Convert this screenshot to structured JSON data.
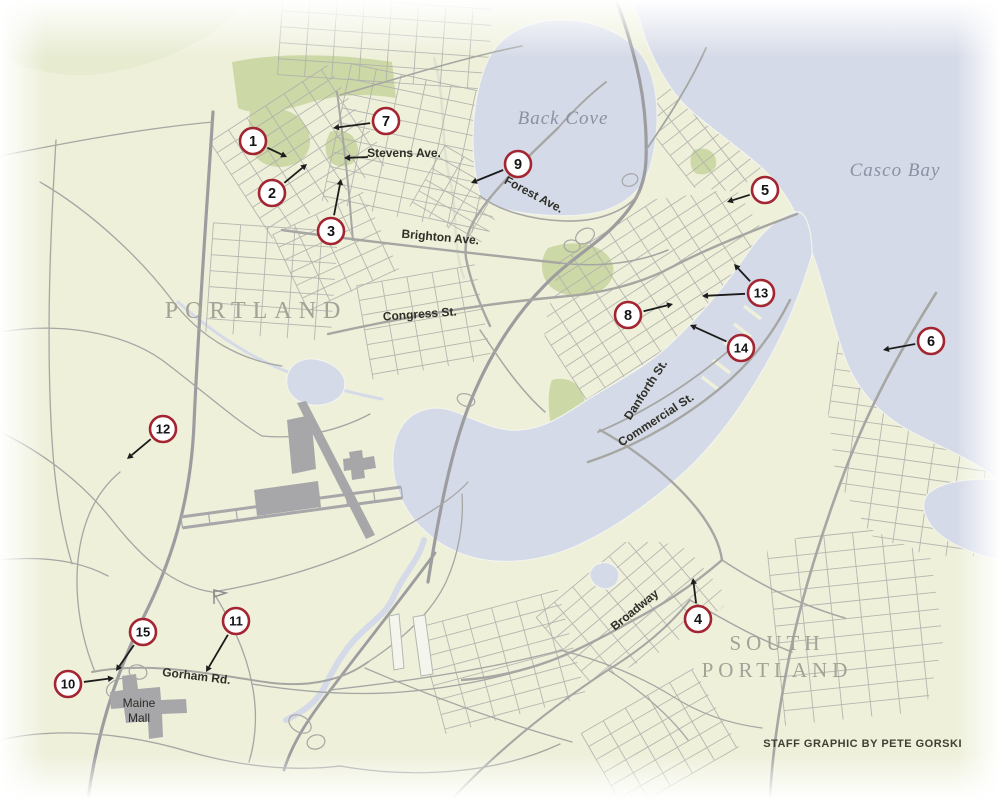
{
  "credit": "STAFF GRAPHIC BY PETE GORSKI",
  "colors": {
    "land": "#eef0da",
    "water": "#d5dae8",
    "water_edge": "#f2f4ec",
    "park": "#ccd8a6",
    "road": "#a6a6a3",
    "road_minor": "#b0b0ac",
    "highway": "#9d9da0",
    "building": "#a7a7aa",
    "marker_ring": "#a32531",
    "marker_fill": "#ffffff",
    "marker_text": "#141414",
    "arrow": "#1c1c1c",
    "city_label": "#a2a297",
    "water_label": "#8b91a2",
    "street_label": "#2f2f27",
    "poi_label": "#2b2b25"
  },
  "city_labels": [
    {
      "text": "PORTLAND",
      "x": 256,
      "y": 318,
      "size": 24,
      "spacing": 7
    },
    {
      "text": "SOUTH",
      "x": 777,
      "y": 650,
      "size": 21,
      "spacing": 5
    },
    {
      "text": "PORTLAND",
      "x": 777,
      "y": 677,
      "size": 21,
      "spacing": 5
    }
  ],
  "water_labels": [
    {
      "text": "Back Cove",
      "x": 563,
      "y": 124,
      "size": 19
    },
    {
      "text": "Casco Bay",
      "x": 895,
      "y": 176,
      "size": 19
    }
  ],
  "poi_labels": [
    {
      "text": "Maine",
      "x": 139,
      "y": 707
    },
    {
      "text": "Mall",
      "x": 139,
      "y": 722
    }
  ],
  "street_labels": [
    {
      "text": "Stevens Ave.",
      "x": 404,
      "y": 157,
      "rot": 0,
      "anchor": "middle",
      "arrow": {
        "x1": 368,
        "y1": 157,
        "x2": 344,
        "y2": 158
      }
    },
    {
      "text": "Forest Ave.",
      "x": 532,
      "y": 198,
      "rot": 28,
      "anchor": "middle"
    },
    {
      "text": "Brighton Ave.",
      "x": 440,
      "y": 241,
      "rot": 5,
      "anchor": "middle"
    },
    {
      "text": "Congress St.",
      "x": 420,
      "y": 318,
      "rot": -4,
      "anchor": "middle"
    },
    {
      "text": "Danforth St.",
      "x": 649,
      "y": 392,
      "rot": -57,
      "anchor": "middle"
    },
    {
      "text": "Commercial St.",
      "x": 658,
      "y": 423,
      "rot": -33,
      "anchor": "middle"
    },
    {
      "text": "Broadway",
      "x": 637,
      "y": 613,
      "rot": -39,
      "anchor": "middle"
    },
    {
      "text": "Gorham Rd.",
      "x": 196,
      "y": 680,
      "rot": 7,
      "anchor": "middle"
    }
  ],
  "markers": [
    {
      "n": "1",
      "cx": 253,
      "cy": 141,
      "arrows": [
        [
          287,
          157
        ]
      ]
    },
    {
      "n": "2",
      "cx": 272,
      "cy": 193,
      "arrows": [
        [
          307,
          164
        ]
      ]
    },
    {
      "n": "3",
      "cx": 331,
      "cy": 231,
      "arrows": [
        [
          341,
          179
        ]
      ]
    },
    {
      "n": "4",
      "cx": 698,
      "cy": 619,
      "arrows": [
        [
          693,
          578
        ]
      ]
    },
    {
      "n": "5",
      "cx": 765,
      "cy": 190,
      "arrows": [
        [
          727,
          202
        ]
      ]
    },
    {
      "n": "6",
      "cx": 931,
      "cy": 341,
      "arrows": [
        [
          883,
          350
        ]
      ]
    },
    {
      "n": "7",
      "cx": 386,
      "cy": 121,
      "arrows": [
        [
          333,
          128
        ]
      ]
    },
    {
      "n": "8",
      "cx": 628,
      "cy": 315,
      "arrows": [
        [
          673,
          304
        ]
      ]
    },
    {
      "n": "9",
      "cx": 518,
      "cy": 164,
      "arrows": [
        [
          471,
          183
        ]
      ]
    },
    {
      "n": "10",
      "cx": 68,
      "cy": 684,
      "arrows": [
        [
          114,
          678
        ]
      ]
    },
    {
      "n": "11",
      "cx": 236,
      "cy": 621,
      "arrows": [
        [
          206,
          672
        ]
      ]
    },
    {
      "n": "12",
      "cx": 163,
      "cy": 429,
      "arrows": [
        [
          127,
          459
        ]
      ]
    },
    {
      "n": "13",
      "cx": 761,
      "cy": 293,
      "arrows": [
        [
          734,
          264
        ],
        [
          702,
          296
        ]
      ]
    },
    {
      "n": "14",
      "cx": 741,
      "cy": 348,
      "arrows": [
        [
          690,
          325
        ]
      ]
    },
    {
      "n": "15",
      "cx": 143,
      "cy": 632,
      "arrows": [
        [
          116,
          671
        ]
      ]
    }
  ],
  "map": {
    "washes": [
      {
        "name": "north-woods-wash",
        "d": "M0,0 L250,0 C210,42 165,62 112,72 C70,80 30,72 0,56 Z",
        "c": "#e3e8ca",
        "o": 0.6
      },
      {
        "name": "cove-north-wash",
        "d": "M250,0 L640,0 L640,26 C520,40 360,36 250,18 Z",
        "c": "#e9edd2",
        "o": 0.5
      }
    ],
    "parks": [
      {
        "name": "evergreen-cemetery",
        "d": "M232,62 C280,52 340,54 392,62 L396,98 C360,92 330,96 305,104 C280,112 255,116 238,108 Z"
      },
      {
        "name": "evergreen-south",
        "d": "M250,108 C280,104 300,112 308,130 C314,148 306,162 288,166 C268,170 252,160 248,142 Z"
      },
      {
        "name": "baxter-woods",
        "d": "M330,132 C344,128 356,134 358,148 C360,160 350,168 338,166 C328,164 324,152 326,142 Z"
      },
      {
        "name": "deering-oaks",
        "d": "M548,248 C570,240 596,242 608,256 C618,268 614,284 598,292 C580,300 558,296 548,284 C540,274 540,258 548,248 Z"
      },
      {
        "name": "eastern-prom",
        "d": "M668,52 C700,40 740,44 775,62 C805,78 828,98 838,118 C830,142 812,158 790,166 C775,150 765,130 752,112 C735,88 700,66 668,52 Z"
      },
      {
        "name": "west-end-green",
        "d": "M552,380 C566,376 580,382 584,398 C590,420 584,444 572,456 C560,452 552,440 550,420 C548,404 548,390 552,380 Z"
      },
      {
        "name": "sp-shore-green",
        "d": "M890,244 C905,238 922,242 930,252 C934,262 928,272 914,274 C900,276 888,268 886,256 Z"
      },
      {
        "name": "peninsula-green",
        "d": "M694,150 C704,146 714,150 716,160 C718,170 708,176 698,174 C690,172 688,158 694,150 Z"
      }
    ],
    "streams": [
      {
        "name": "stroudwater-river",
        "d": "M178,302 C215,335 252,358 288,372 C318,384 350,393 382,399",
        "w": 3
      },
      {
        "name": "fore-river-arm",
        "d": "M424,540 C418,562 402,576 394,596 C386,614 372,622 358,636 C344,650 334,668 324,688 C314,706 298,714 286,720",
        "w": 6
      },
      {
        "name": "presumpscot-stream",
        "d": "M434,58 C446,98 440,140 450,180 C458,214 452,246 464,278",
        "w": 2.5,
        "c": "#dde3cf"
      }
    ],
    "grids": [
      {
        "name": "deering-center",
        "cx": 300,
        "cy": 152,
        "w": 140,
        "h": 115,
        "rot": -33,
        "step": 13
      },
      {
        "name": "oakdale",
        "cx": 420,
        "cy": 150,
        "w": 170,
        "h": 140,
        "rot": 12,
        "step": 15
      },
      {
        "name": "north-deering",
        "cx": 385,
        "cy": 42,
        "w": 210,
        "h": 80,
        "rot": 4,
        "step": 16
      },
      {
        "name": "back-cove-west",
        "cx": 462,
        "cy": 196,
        "w": 80,
        "h": 70,
        "rot": 30,
        "step": 13
      },
      {
        "name": "east-deering",
        "cx": 744,
        "cy": 108,
        "w": 175,
        "h": 120,
        "rot": -38,
        "step": 13,
        "clip": "M645,95 L668,42 L705,26 L762,44 L842,112 L800,172 L738,192 L678,186 L648,150 Z"
      },
      {
        "name": "peninsula",
        "cx": 668,
        "cy": 305,
        "w": 240,
        "h": 190,
        "rot": -33,
        "step": 13,
        "clip": "M560,258 L610,215 L648,200 L700,194 L800,178 L808,220 L772,262 L730,322 L688,372 L648,416 L608,442 L574,432 L552,398 L544,330 Z"
      },
      {
        "name": "libbytown",
        "cx": 424,
        "cy": 322,
        "w": 120,
        "h": 95,
        "rot": -10,
        "step": 15
      },
      {
        "name": "nasons-corner",
        "cx": 272,
        "cy": 282,
        "w": 125,
        "h": 110,
        "rot": 4,
        "step": 16
      },
      {
        "name": "rosemont",
        "cx": 336,
        "cy": 252,
        "w": 100,
        "h": 85,
        "rot": -25,
        "step": 14
      },
      {
        "name": "sp-center",
        "cx": 636,
        "cy": 612,
        "w": 160,
        "h": 120,
        "rot": -40,
        "step": 14,
        "clip": "M545,572 L602,542 L662,542 L732,562 L724,606 L668,648 L600,682 L540,676 L516,630 Z"
      },
      {
        "name": "sp-east",
        "cx": 916,
        "cy": 420,
        "w": 175,
        "h": 270,
        "rot": 8,
        "step": 16,
        "clip": "M836,282 L886,300 L940,288 L1000,320 L1000,556 L930,556 L872,536 L836,478 L824,380 L824,318 Z"
      },
      {
        "name": "sp-ferry-village",
        "cx": 858,
        "cy": 625,
        "w": 165,
        "h": 185,
        "rot": -6,
        "step": 17,
        "clip": "M768,548 L850,520 L930,556 L944,640 L922,722 L858,762 L788,770 L760,700 L760,600 Z"
      },
      {
        "name": "sp-west",
        "cx": 502,
        "cy": 662,
        "w": 145,
        "h": 110,
        "rot": -15,
        "step": 15
      },
      {
        "name": "sp-south",
        "cx": 660,
        "cy": 740,
        "w": 130,
        "h": 90,
        "rot": -30,
        "step": 15
      }
    ],
    "water": [
      {
        "name": "back-cove",
        "d": "M480,196 C468,150 472,95 488,60 C500,35 525,22 555,20 C595,18 632,36 646,62 C659,87 660,126 652,160 C645,190 625,205 600,212 C565,220 518,214 498,207 C488,203 483,200 480,196 Z"
      },
      {
        "name": "casco-bay",
        "d": "M630,0 L1000,0 L1000,480 C965,455 935,445 908,430 C878,413 856,388 845,358 C832,322 824,286 814,258 C800,218 786,190 762,168 C740,148 710,128 690,110 C668,90 650,55 642,28 C638,14 634,6 630,0 Z"
      },
      {
        "name": "fore-river-harbor",
        "d": "M812,255 C800,295 786,330 764,368 C740,410 712,448 678,478 C646,506 612,530 576,546 C540,562 500,566 468,556 C436,546 412,524 400,496 C390,472 390,444 402,426 C414,408 436,404 456,412 C476,420 498,432 520,430 C548,428 568,412 590,398 C616,382 644,368 668,346 C696,320 722,290 744,258 C760,234 778,216 796,212 C806,210 812,230 812,255 Z"
      },
      {
        "name": "capisic-pond",
        "d": "M287,377 C290,362 305,356 320,360 C338,365 348,376 344,390 C340,402 322,408 306,404 C292,400 285,390 287,377 Z"
      },
      {
        "name": "sp-pond",
        "d": "M590,572 C594,562 606,560 614,566 C622,572 620,584 610,588 C600,592 588,582 590,572 Z"
      },
      {
        "name": "right-inlet",
        "d": "M1000,480 L1000,560 C975,555 950,545 935,530 C922,516 920,500 930,492 C945,480 975,478 1000,480 Z"
      }
    ],
    "piers": [
      [
        744,
        306
      ],
      [
        734,
        324
      ],
      [
        724,
        342
      ],
      [
        713,
        360
      ],
      [
        702,
        377
      ]
    ],
    "roads": [
      {
        "name": "i95-turnpike",
        "d": "M213,112 C206,220 198,330 194,424 C191,494 175,552 148,608 C124,656 99,718 88,799",
        "w": 3.2,
        "hw": true
      },
      {
        "name": "i295",
        "d": "M428,582 C440,506 452,450 468,408 C484,366 510,320 545,285 C570,259 598,244 618,222 C636,203 645,185 646,160 C647,130 644,96 636,64 C630,40 624,20 616,0",
        "w": 3.2,
        "hw": true
      },
      {
        "name": "i295-sp-connector",
        "d": "M435,553 C402,598 362,648 332,688 C307,720 292,744 284,770",
        "w": 2.8,
        "hw": true
      },
      {
        "name": "route77",
        "d": "M936,293 C900,350 868,410 846,468 C823,528 801,598 789,658 C779,708 772,755 770,799",
        "w": 2.6
      },
      {
        "name": "forest-ave",
        "d": "M558,128 C530,155 498,185 481,210 C469,226 464,240 466,258 C470,280 479,302 490,326",
        "w": 2.4
      },
      {
        "name": "forest-ave-north",
        "d": "M558,128 C572,112 588,96 606,82",
        "w": 1.8
      },
      {
        "name": "stevens-ave",
        "d": "M337,92 C342,130 347,170 350,205 C351,218 352,230 353,240",
        "w": 2
      },
      {
        "name": "brighton-ave",
        "d": "M282,230 C360,241 480,254 560,263",
        "w": 2.4
      },
      {
        "name": "congress-st",
        "d": "M328,334 C400,318 480,304 558,297 C600,294 640,284 672,267 C710,247 762,227 797,214",
        "w": 2.4
      },
      {
        "name": "commercial-st",
        "d": "M588,462 C640,445 692,414 732,378 C757,355 776,328 790,300",
        "w": 2.4
      },
      {
        "name": "danforth-st",
        "d": "M598,432 C650,410 700,377 736,344",
        "w": 1.8
      },
      {
        "name": "casco-bridge-broadway",
        "d": "M600,430 C640,452 676,482 698,510 C712,528 720,545 722,560 C690,588 660,606 630,622 C598,640 574,652 550,661 C520,672 490,678 462,680",
        "w": 2.4
      },
      {
        "name": "gorham-rd",
        "d": "M92,672 C150,661 210,674 265,682 C312,689 346,678 368,662",
        "w": 2
      },
      {
        "name": "route1-sp",
        "d": "M452,799 C500,748 556,704 608,670 C640,650 668,628 690,600",
        "w": 2
      },
      {
        "name": "baxter-blvd",
        "d": "M480,196 C498,210 530,220 565,221 C600,222 628,210 640,192",
        "w": 1.6
      },
      {
        "name": "washington-ave",
        "d": "M646,150 C668,118 690,84 706,48",
        "w": 1.8
      },
      {
        "name": "allen-ave",
        "d": "M340,95 C400,78 462,58 522,46",
        "w": 1.6
      },
      {
        "name": "park-ave",
        "d": "M560,263 C600,268 640,262 668,250",
        "w": 1.5
      },
      {
        "name": "st-john-st",
        "d": "M480,330 C500,360 520,390 545,412",
        "w": 1.5
      },
      {
        "name": "riverside-st",
        "d": "M56,140 C50,240 46,340 52,440 C55,490 62,530 72,564",
        "w": 1.3
      },
      {
        "name": "warren-ave",
        "d": "M0,156 C70,142 145,128 213,122",
        "w": 1.3
      },
      {
        "name": "brighton-west",
        "d": "M0,332 C60,322 122,332 162,360 C202,390 235,420 262,436",
        "w": 1.3
      },
      {
        "name": "outer-congress",
        "d": "M40,182 C92,212 142,260 172,300 C202,340 242,360 282,366",
        "w": 1.3
      },
      {
        "name": "congress-stroudwater",
        "d": "M262,436 C300,440 340,430 370,414",
        "w": 1.3
      },
      {
        "name": "westbrook-st",
        "d": "M0,432 C42,452 82,482 112,520 C140,556 172,586 212,592",
        "w": 1.3
      },
      {
        "name": "payne-rd",
        "d": "M213,592 C232,622 246,652 252,684 C257,708 257,736 249,762",
        "w": 1.3
      },
      {
        "name": "westbrook-st-e",
        "d": "M213,592 C262,584 322,568 372,544 C420,520 452,500 468,482",
        "w": 1.3
      },
      {
        "name": "maine-mall-rd",
        "d": "M95,672 C82,640 74,600 78,560 C82,522 96,492 120,472",
        "w": 1.3
      },
      {
        "name": "western-ave-sp",
        "d": "M368,662 C402,640 432,612 446,582 C458,556 464,524 462,494",
        "w": 1.3
      },
      {
        "name": "gorham-rd-east",
        "d": "M252,684 C302,692 352,696 402,692 C452,688 502,678 548,662",
        "w": 1.3
      },
      {
        "name": "main-st-sp",
        "d": "M330,690 C420,680 502,666 562,650",
        "w": 1.3
      },
      {
        "name": "spring-st-sp",
        "d": "M365,668 C430,696 500,722 572,742",
        "w": 1.3
      },
      {
        "name": "bottom-hwy-1",
        "d": "M0,740 C60,726 130,734 190,752 C240,766 290,772 340,766",
        "w": 1.3
      },
      {
        "name": "bottom-hwy-2",
        "d": "M340,766 C420,780 500,772 560,744",
        "w": 1.3
      },
      {
        "name": "left-rd",
        "d": "M0,560 C40,556 78,560 108,576",
        "w": 1.3
      },
      {
        "name": "cottage-rd",
        "d": "M690,600 C724,620 756,638 792,652",
        "w": 1.5
      },
      {
        "name": "sp-shore-rd",
        "d": "M722,560 C760,585 800,605 845,618",
        "w": 1.5
      },
      {
        "name": "highland-ave",
        "d": "M560,650 C600,660 640,676 672,696 C700,714 730,724 762,728",
        "w": 1.3
      },
      {
        "name": "evans-st",
        "d": "M608,670 C640,690 668,714 688,740",
        "w": 1.3
      }
    ],
    "loops": [
      {
        "cx": 585,
        "cy": 236,
        "rx": 10,
        "ry": 7,
        "rot": -30
      },
      {
        "cx": 572,
        "cy": 246,
        "rx": 8,
        "ry": 6,
        "rot": 10
      },
      {
        "cx": 466,
        "cy": 400,
        "rx": 9,
        "ry": 6,
        "rot": 20
      },
      {
        "cx": 120,
        "cy": 688,
        "rx": 14,
        "ry": 9,
        "rot": -20
      },
      {
        "cx": 138,
        "cy": 672,
        "rx": 9,
        "ry": 7,
        "rot": 15
      },
      {
        "cx": 300,
        "cy": 724,
        "rx": 12,
        "ry": 8,
        "rot": 30
      },
      {
        "cx": 316,
        "cy": 742,
        "rx": 9,
        "ry": 7,
        "rot": -15
      },
      {
        "cx": 630,
        "cy": 180,
        "rx": 8,
        "ry": 6,
        "rot": -20
      }
    ],
    "runway": {
      "x1": 181,
      "y1": 517,
      "x2": 401,
      "y2": 487,
      "gap": 11,
      "rungs": 8
    },
    "buildings": [
      {
        "name": "runway-diagonal",
        "d": "M297,403 L306,401 L375,535 L366,539 Z"
      },
      {
        "name": "airport-apron-north",
        "d": "M287,420 L311,415 L316,469 L292,474 Z"
      },
      {
        "name": "airport-apron-main",
        "d": "M254,490 L318,481 L321,507 L257,516 Z"
      },
      {
        "name": "airport-terminal",
        "d": "M349,452 L362,450 L363,458 L374,456 L376,468 L364,470 L365,478 L352,480 L351,470 L344,471 L343,459 L350,458 Z"
      },
      {
        "name": "maine-mall-building",
        "d": "M110,692 L123,690 L122,676 L136,674 L138,689 L160,687 L161,700 L186,699 L187,713 L162,714 L163,737 L149,739 L148,721 L126,723 L124,708 L111,709 Z"
      }
    ],
    "lots": [
      {
        "name": "industrial-lot-1",
        "d": "M389,616 L399,614 L404,668 L394,670 Z"
      },
      {
        "name": "industrial-lot-2",
        "d": "M413,617 L425,615 L433,674 L421,676 Z"
      }
    ],
    "flag": {
      "x": 214,
      "y": 590
    }
  }
}
